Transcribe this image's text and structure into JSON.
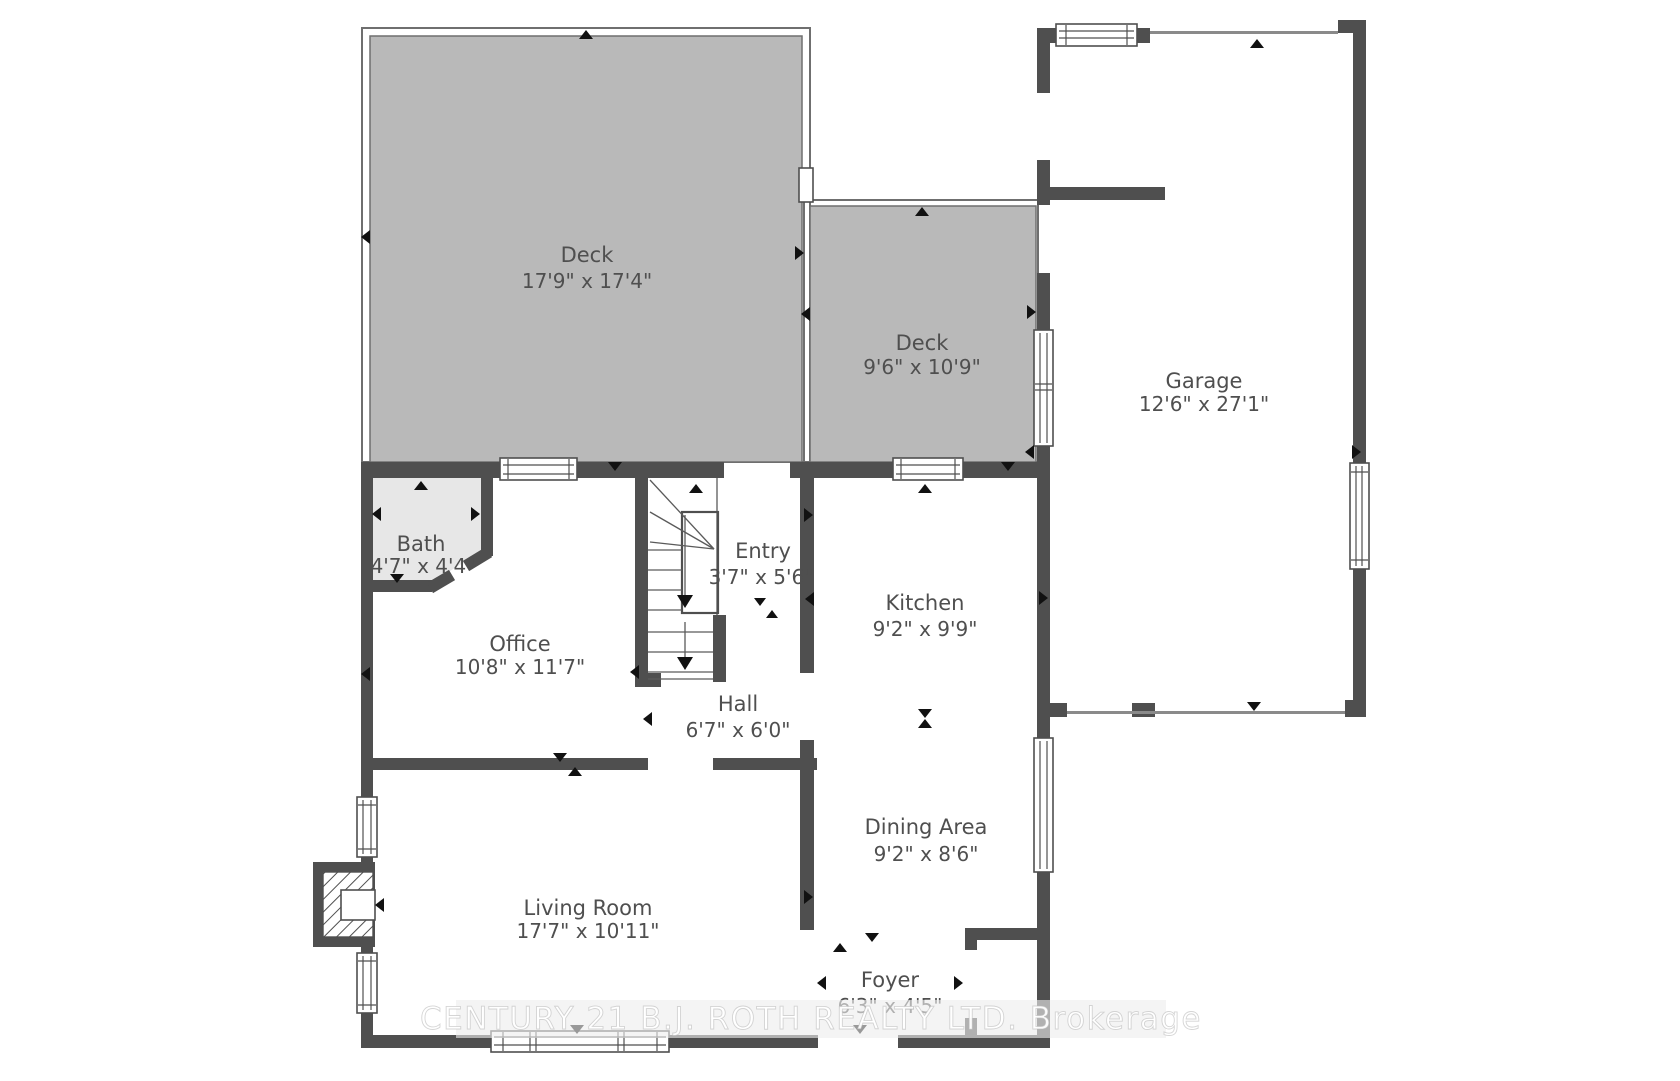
{
  "plan": {
    "rooms": {
      "deck_large": {
        "name": "Deck",
        "dims": "17'9\" x 17'4\""
      },
      "deck_small": {
        "name": "Deck",
        "dims": "9'6\" x 10'9\""
      },
      "garage": {
        "name": "Garage",
        "dims": "12'6\" x 27'1\""
      },
      "bath": {
        "name": "Bath",
        "dims": "4'7\" x 4'4\""
      },
      "office": {
        "name": "Office",
        "dims": "10'8\" x 11'7\""
      },
      "entry": {
        "name": "Entry",
        "dims": "3'7\" x 5'6\""
      },
      "kitchen": {
        "name": "Kitchen",
        "dims": "9'2\" x 9'9\""
      },
      "hall": {
        "name": "Hall",
        "dims": "6'7\" x 6'0\""
      },
      "dining": {
        "name": "Dining Area",
        "dims": "9'2\" x 8'6\""
      },
      "living": {
        "name": "Living Room",
        "dims": "17'7\" x 10'11\""
      },
      "foyer": {
        "name": "Foyer",
        "dims": "6'3\" x 4'5\""
      }
    },
    "watermark": "CENTURY 21 B.J. ROTH REALTY LTD.  Brokerage",
    "colors": {
      "wall": "#4f4f4f",
      "deck_fill": "#b9b9b9",
      "bath_fill": "#e7e7e7",
      "label": "#4f4f4f",
      "background": "#ffffff"
    }
  }
}
